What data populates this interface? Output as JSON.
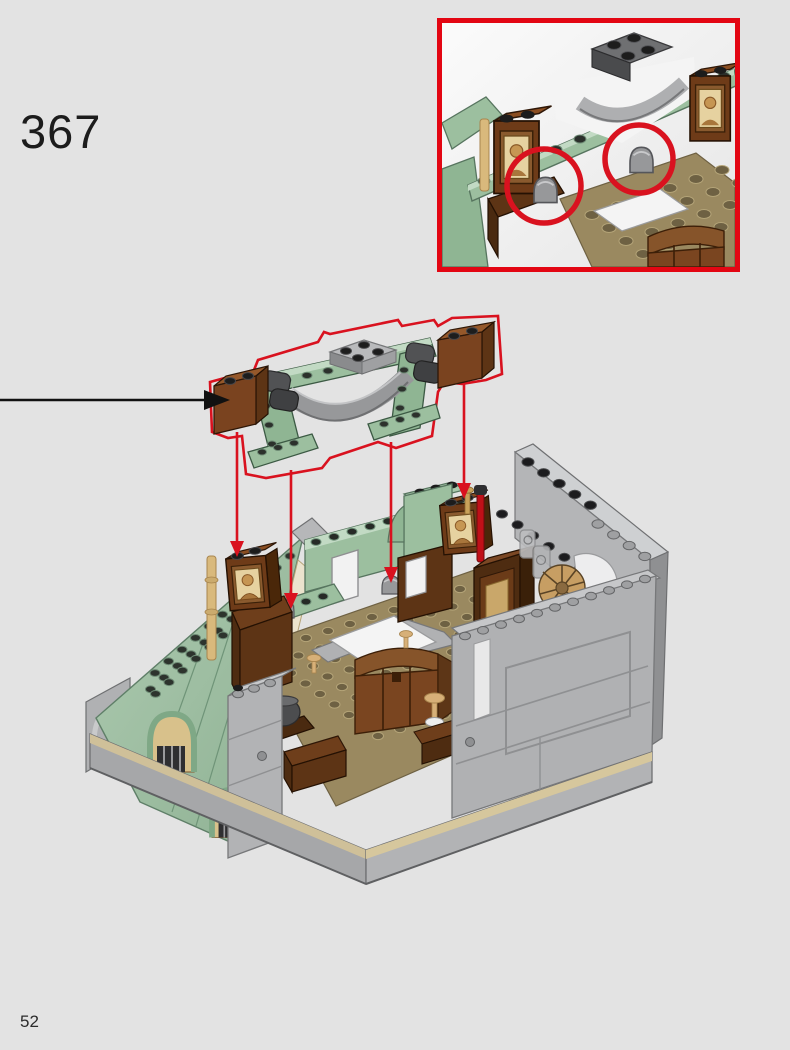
{
  "page": {
    "step_number": "367",
    "page_number": "52",
    "background": "#e3e3e3",
    "text_color": "#1c1c1c"
  },
  "callout": {
    "type": "zoom-detail-box",
    "border_color": "#e30613",
    "highlight_circles": 2,
    "shows": "close-up of arch frame placement with two clip positions circled"
  },
  "diagram": {
    "part_outline_color": "#d9121f",
    "guide_line_count": 4,
    "insertion_arrow_color": "#111111",
    "palette": {
      "sage_green": "#9cbf9f",
      "sage_green_light": "#c2dac4",
      "sage_green_dark": "#74997e",
      "light_gray": "#b3b4b6",
      "light_gray_bright": "#cfd0d2",
      "stone_gray": "#a2a3a5",
      "dark_gray": "#4a4b4d",
      "reddish_brown": "#7a431f",
      "dark_brown": "#4e2c11",
      "tan": "#d9b97c",
      "dark_tan_floor": "#9a8960",
      "black": "#1d1d1d",
      "white": "#f4f4f4",
      "red_piece": "#c01018"
    }
  }
}
